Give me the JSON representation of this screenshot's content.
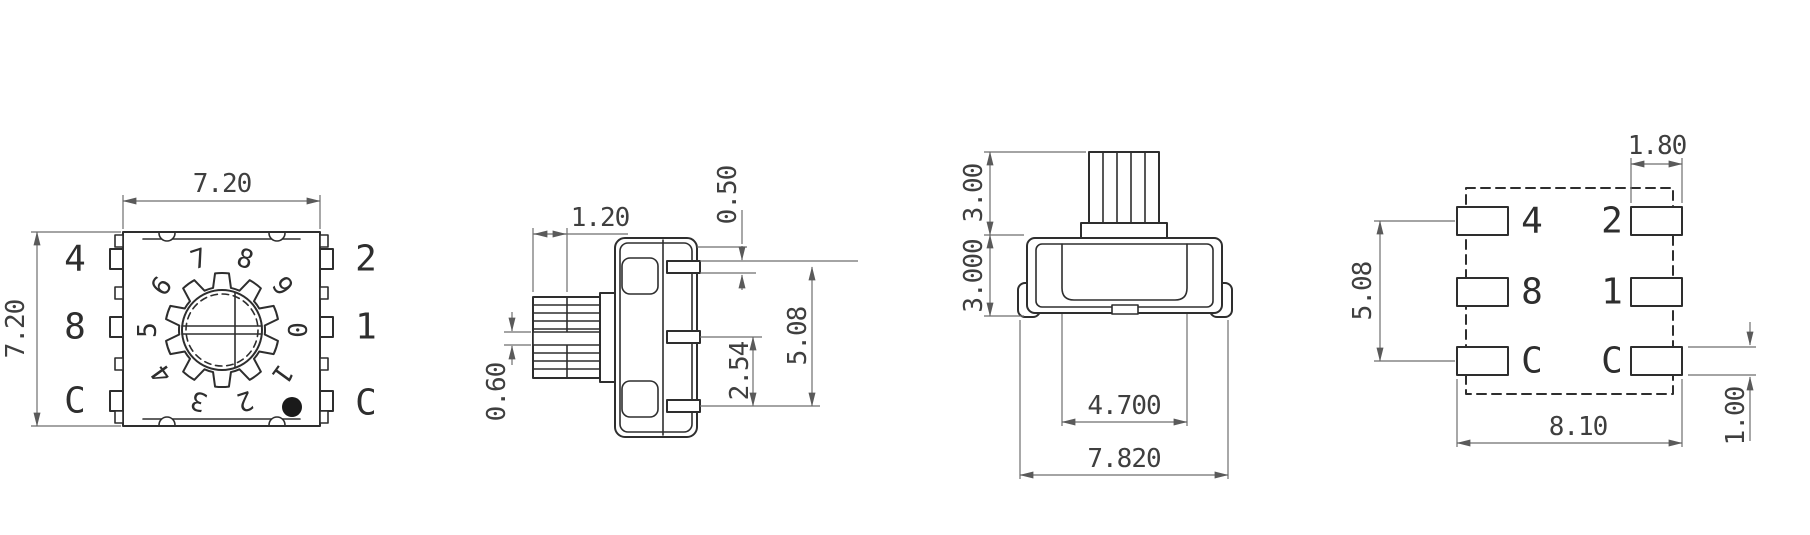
{
  "drawing": {
    "views": {
      "top": {
        "width_dim": "7.20",
        "height_dim": "7.20",
        "left_pin_labels": [
          "4",
          "8",
          "C"
        ],
        "right_pin_labels": [
          "2",
          "1",
          "C"
        ],
        "dial_digits": [
          "0",
          "1",
          "2",
          "3",
          "4",
          "5",
          "6",
          "7",
          "8",
          "9"
        ]
      },
      "side": {
        "knurl_width_dim": "1.20",
        "pin_thickness_dim": "0.50",
        "slot_width_dim": "0.60",
        "pin_pitch_dim": "2.54",
        "pin_span_dim": "5.08"
      },
      "front": {
        "shaft_height_dim": "3.00",
        "body_height_dim": "3.000",
        "inner_width_dim": "4.700",
        "overall_width_dim": "7.820"
      },
      "land_pattern": {
        "pad_width_dim": "1.80",
        "row_pitch_dim": "5.08",
        "span_dim": "8.10",
        "pad_height_dim": "1.00",
        "left_pad_labels": [
          "4",
          "8",
          "C"
        ],
        "right_pad_labels": [
          "2",
          "1",
          "C"
        ]
      }
    },
    "colors": {
      "part_line": "#2e2e2e",
      "dim_line": "#6e6e6e",
      "dim_text": "#3f3f3f",
      "marker_dot": "#1a1a1a",
      "background": "#ffffff"
    }
  }
}
